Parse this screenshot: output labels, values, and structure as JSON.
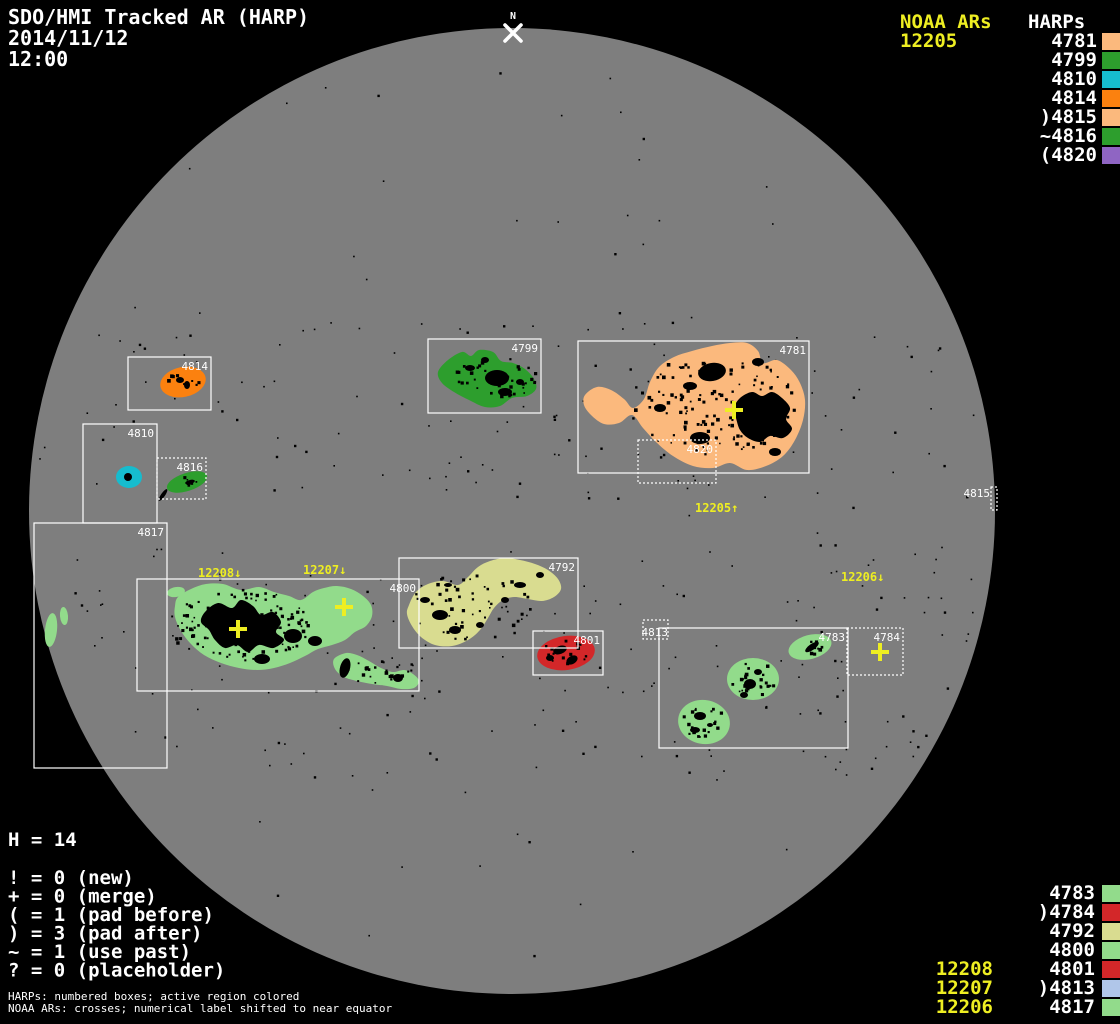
{
  "header": {
    "title": "SDO/HMI Tracked AR (HARP)",
    "date": "2014/11/12",
    "time": "12:00",
    "north_label": "N"
  },
  "colors": {
    "background": "#000000",
    "disk": "#7E7E7E",
    "white": "#FFFFFF",
    "yellow": "#EEEE22",
    "peach": "#FBB97D",
    "green": "#2D9E2D",
    "cyan": "#16BCCE",
    "orange": "#FB810F",
    "purple": "#8F65C3",
    "light_green": "#92DB8B",
    "red": "#D32729",
    "khaki": "#D9DC90",
    "light_blue": "#B0C6E9"
  },
  "legend_top": {
    "noaa_heading": "NOAA ARs",
    "noaa_items": [
      "12205"
    ],
    "harps_heading": "HARPs",
    "harp_items": [
      {
        "text": "4781",
        "color": "peach"
      },
      {
        "text": "4799",
        "color": "green"
      },
      {
        "text": "4810",
        "color": "cyan"
      },
      {
        "text": "4814",
        "color": "orange"
      },
      {
        "text": ")4815",
        "color": "peach"
      },
      {
        "text": "~4816",
        "color": "green"
      },
      {
        "text": "(4820",
        "color": "purple"
      }
    ]
  },
  "legend_bottom": {
    "harp_items": [
      {
        "text": "4783",
        "color": "light_green"
      },
      {
        "text": ")4784",
        "color": "red"
      },
      {
        "text": "4792",
        "color": "khaki"
      },
      {
        "text": "4800",
        "color": "light_green"
      },
      {
        "text": "4801",
        "color": "red"
      },
      {
        "text": ")4813",
        "color": "light_blue"
      },
      {
        "text": "4817",
        "color": "light_green"
      }
    ],
    "noaa_items": [
      "12208",
      "12207",
      "12206"
    ]
  },
  "stats": {
    "h_line": "H = 14",
    "items": [
      "! = 0 (new)",
      "+ = 0 (merge)",
      "( = 1 (pad before)",
      ") = 3 (pad after)",
      "~ = 1 (use past)",
      "? = 0 (placeholder)"
    ]
  },
  "footnotes": [
    "HARPs: numbered boxes; active region colored",
    "NOAA ARs: crosses; numerical label shifted to near equator"
  ],
  "chart_data": {
    "type": "scatter",
    "title": "SDO/HMI Tracked AR (HARP)",
    "timestamp": "2014/11/12 12:00",
    "h_total": 14,
    "solar_disk": {
      "cx": 512,
      "cy": 511,
      "r": 483
    },
    "harp_regions": [
      {
        "harp": "4814",
        "color": "orange",
        "dotted": false,
        "box": {
          "x": 128,
          "y": 357,
          "w": 83,
          "h": 53
        }
      },
      {
        "harp": "4810",
        "color": "cyan",
        "dotted": false,
        "box": {
          "x": 83,
          "y": 424,
          "w": 74,
          "h": 99
        }
      },
      {
        "harp": "4816",
        "color": "green",
        "dotted": true,
        "box": {
          "x": 157,
          "y": 458,
          "w": 49,
          "h": 41
        }
      },
      {
        "harp": "4817",
        "color": "light_green",
        "dotted": false,
        "box": {
          "x": 34,
          "y": 523,
          "w": 133,
          "h": 245
        }
      },
      {
        "harp": "4799",
        "color": "green",
        "dotted": false,
        "box": {
          "x": 428,
          "y": 339,
          "w": 113,
          "h": 74
        }
      },
      {
        "harp": "4781",
        "color": "peach",
        "dotted": false,
        "box": {
          "x": 578,
          "y": 341,
          "w": 231,
          "h": 132
        }
      },
      {
        "harp": "4820",
        "color": "purple",
        "dotted": true,
        "box": {
          "x": 638,
          "y": 440,
          "w": 78,
          "h": 43
        }
      },
      {
        "harp": "4815",
        "color": "peach",
        "dotted": true,
        "box": {
          "x": 991,
          "y": 487,
          "w": 6,
          "h": 23
        }
      },
      {
        "harp": "4800",
        "color": "light_green",
        "dotted": false,
        "box": {
          "x": 137,
          "y": 579,
          "w": 282,
          "h": 112
        }
      },
      {
        "harp": "4792",
        "color": "khaki",
        "dotted": false,
        "box": {
          "x": 399,
          "y": 558,
          "w": 179,
          "h": 90
        }
      },
      {
        "harp": "4801",
        "color": "red",
        "dotted": false,
        "box": {
          "x": 533,
          "y": 631,
          "w": 70,
          "h": 44
        }
      },
      {
        "harp": "4813",
        "color": "light_blue",
        "dotted": true,
        "box": {
          "x": 643,
          "y": 620,
          "w": 25,
          "h": 19
        }
      },
      {
        "harp": "4783",
        "color": "light_green",
        "dotted": false,
        "box": {
          "x": 659,
          "y": 628,
          "w": 189,
          "h": 120
        }
      },
      {
        "harp": "4784",
        "color": "red",
        "dotted": true,
        "box": {
          "x": 847,
          "y": 628,
          "w": 56,
          "h": 47
        }
      }
    ],
    "noaa_ars": [
      {
        "number": "12205",
        "label": "12205↑",
        "label_x": 695,
        "label_y": 512,
        "cross_x": 734,
        "cross_y": 410
      },
      {
        "number": "12208",
        "label": "12208↓",
        "label_x": 198,
        "label_y": 577,
        "cross_x": 238,
        "cross_y": 629
      },
      {
        "number": "12207",
        "label": "12207↓",
        "label_x": 303,
        "label_y": 574,
        "cross_x": 344,
        "cross_y": 607
      },
      {
        "number": "12206",
        "label": "12206↓",
        "label_x": 841,
        "label_y": 581,
        "cross_x": 880,
        "cross_y": 652
      }
    ]
  }
}
